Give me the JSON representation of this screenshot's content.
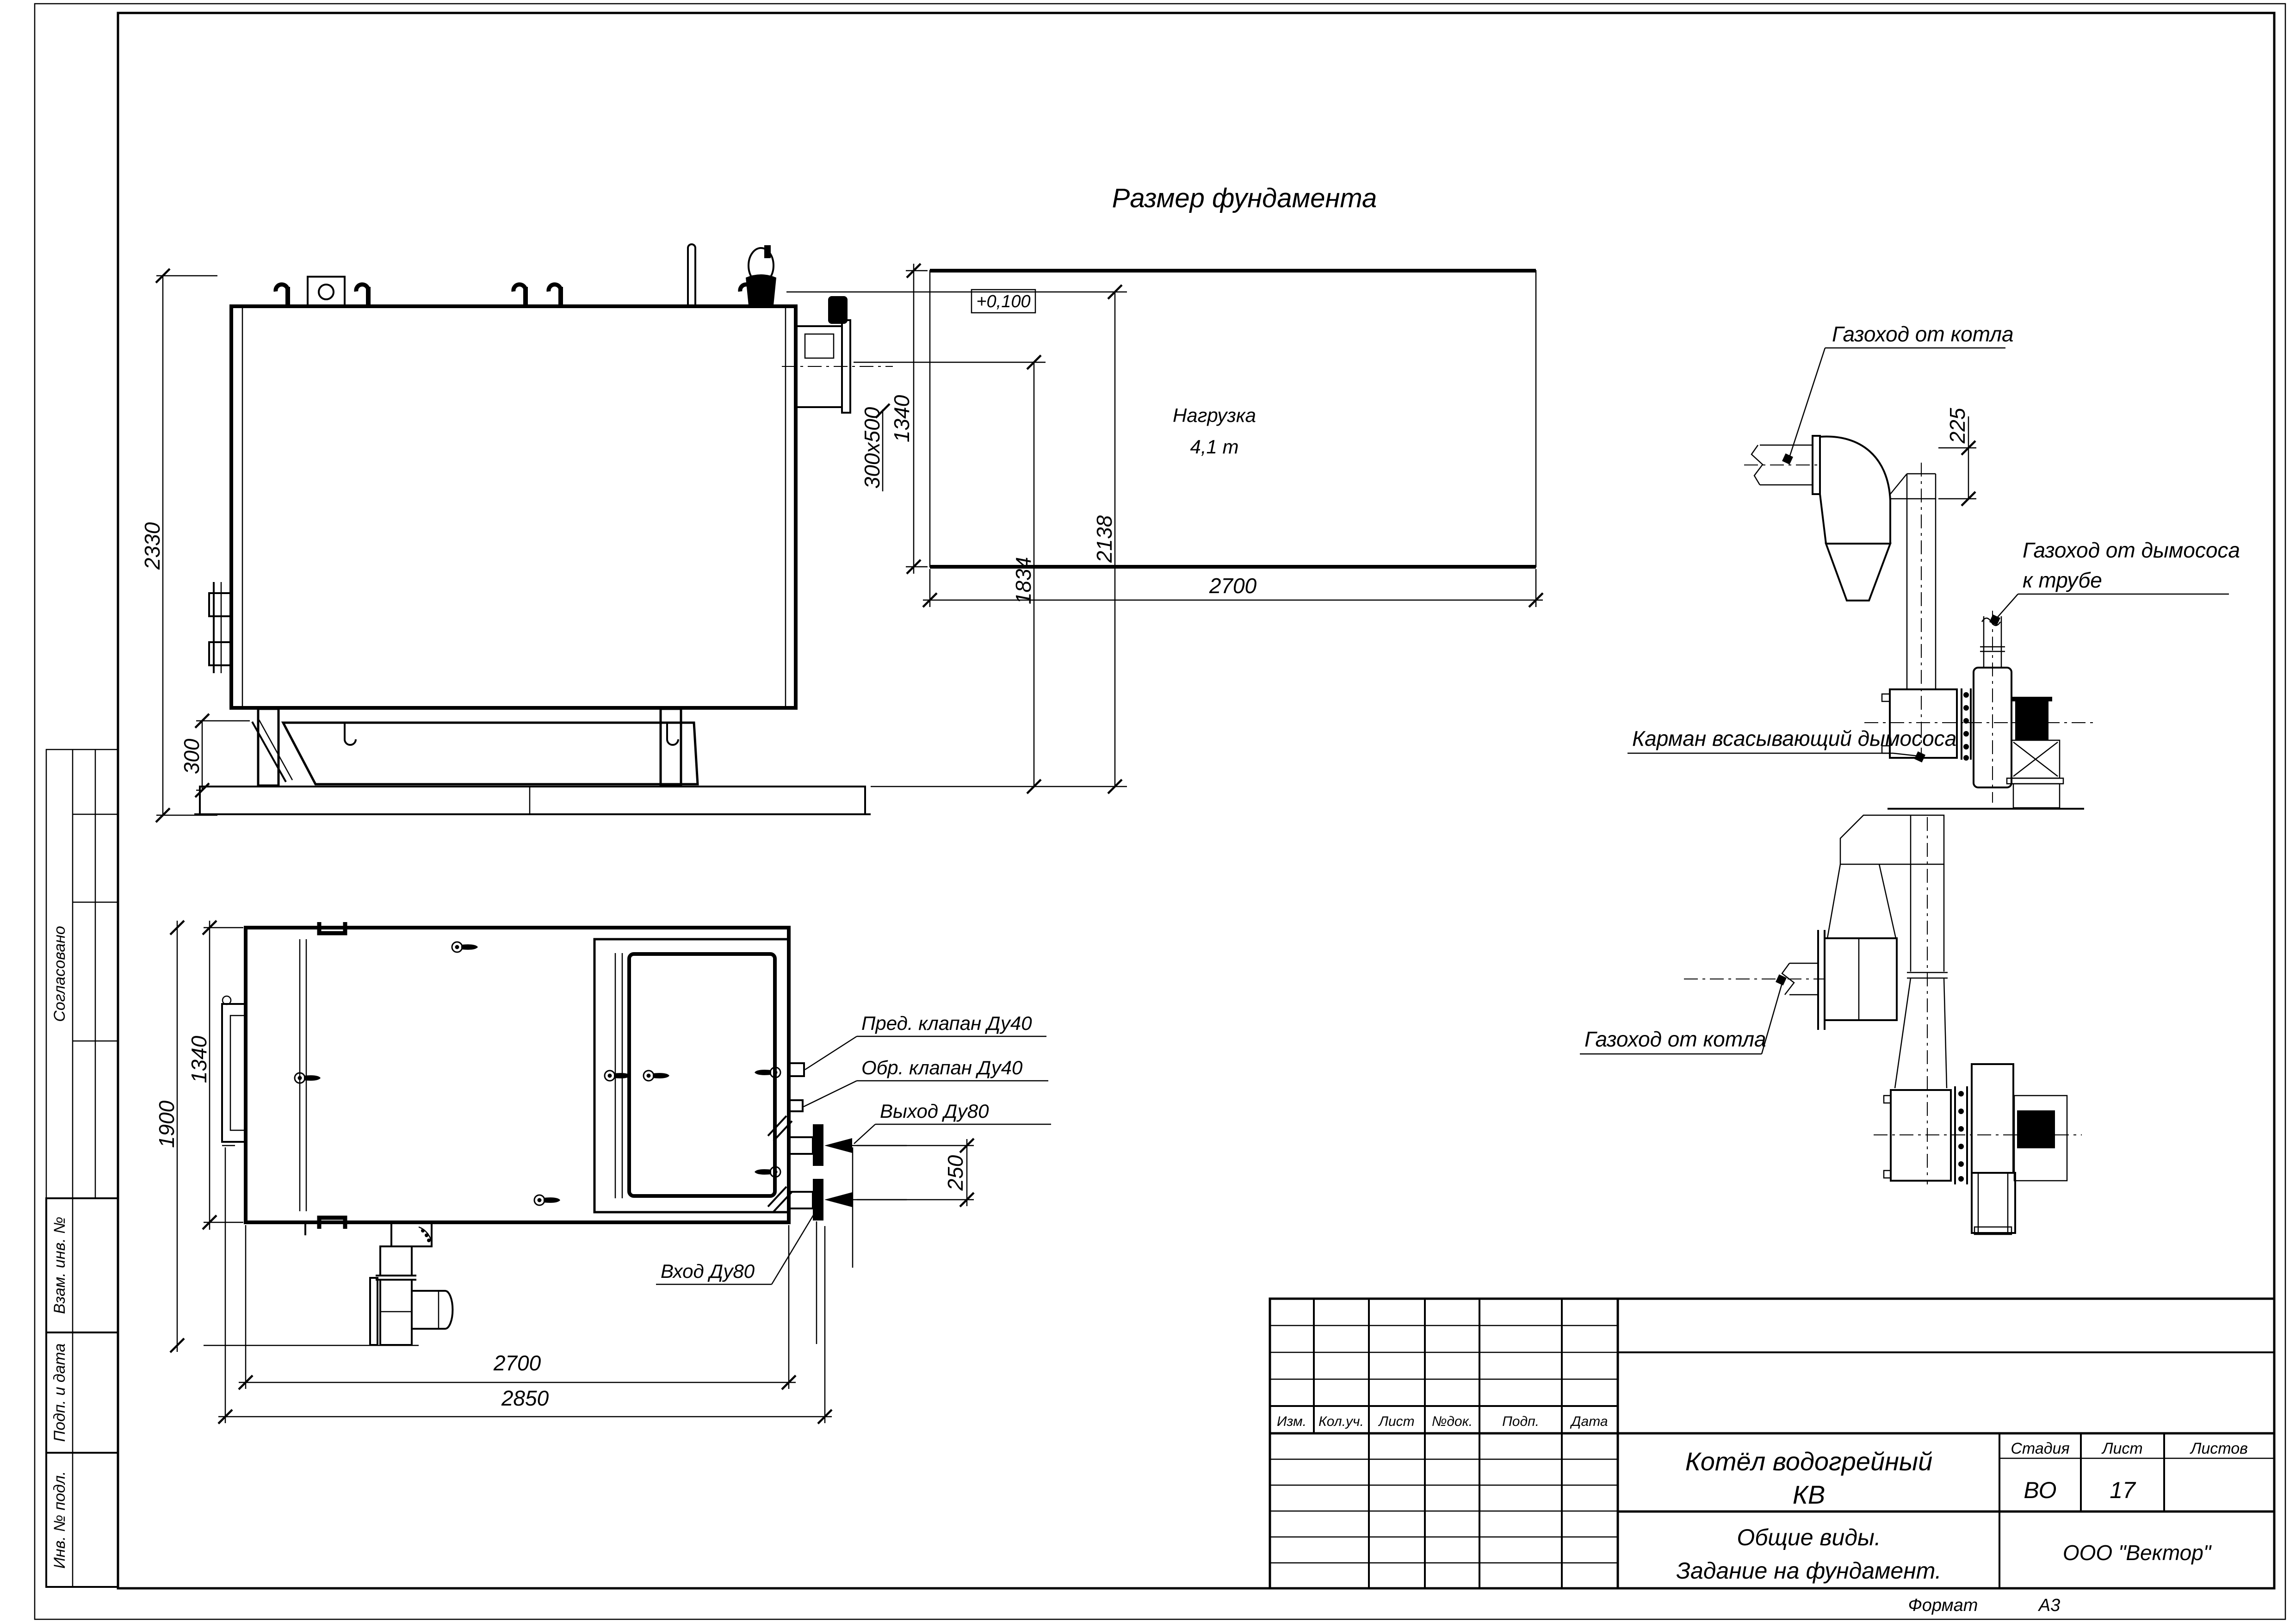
{
  "sheet": {
    "left_stamp": {
      "approved": "Согласовано",
      "replace_inv": "Взам. инв. №",
      "sign_date": "Подп. и дата",
      "inv_orig": "Инв. № подл."
    },
    "footer": {
      "format_label": "Формат",
      "format_value": "А3"
    }
  },
  "views": {
    "side_view": {
      "dims": {
        "height_total": "2330",
        "bottom": "300",
        "duct_section": "300х500",
        "h_mid": "1834",
        "h_top": "2138"
      }
    },
    "foundation_plan": {
      "title": "Размер фундамента",
      "level_mark": "+0,100",
      "load_line1": "Нагрузка",
      "load_line2": "4,1 т",
      "dims": {
        "width": "1340",
        "length": "2700"
      }
    },
    "duct_side": {
      "labels": {
        "from_boiler": "Газоход от котла",
        "to_stack_1": "Газоход от дымососа",
        "to_stack_2": "к трубе",
        "pocket": "Карман всасывающий дымососа"
      },
      "dims": {
        "offset": "225"
      }
    },
    "duct_plan": {
      "labels": {
        "from_boiler": "Газоход от котла"
      }
    },
    "boiler_plan": {
      "labels": {
        "safety_valve": "Пред. клапан Ду40",
        "check_valve": "Обр. клапан Ду40",
        "outlet": "Выход Ду80",
        "inlet": "Вход Ду80"
      },
      "dims": {
        "width": "1340",
        "depth": "1900",
        "length": "2700",
        "length_total": "2850",
        "ports_spacing": "250"
      }
    }
  },
  "title_block": {
    "header": {
      "izm": "Изм.",
      "koluch": "Кол.уч.",
      "list": "Лист",
      "ndok": "№док.",
      "podp": "Подп.",
      "data": "Дата"
    },
    "doc_title_1": "Котёл водогрейный",
    "doc_title_2": "КВ",
    "stage_label": "Стадия",
    "sheet_label": "Лист",
    "sheets_label": "Листов",
    "stage_value": "ВО",
    "sheet_value": "17",
    "sheets_value": "",
    "subtitle_1": "Общие виды.",
    "subtitle_2": "Задание на фундамент.",
    "company": "ООО \"Вектор\""
  }
}
